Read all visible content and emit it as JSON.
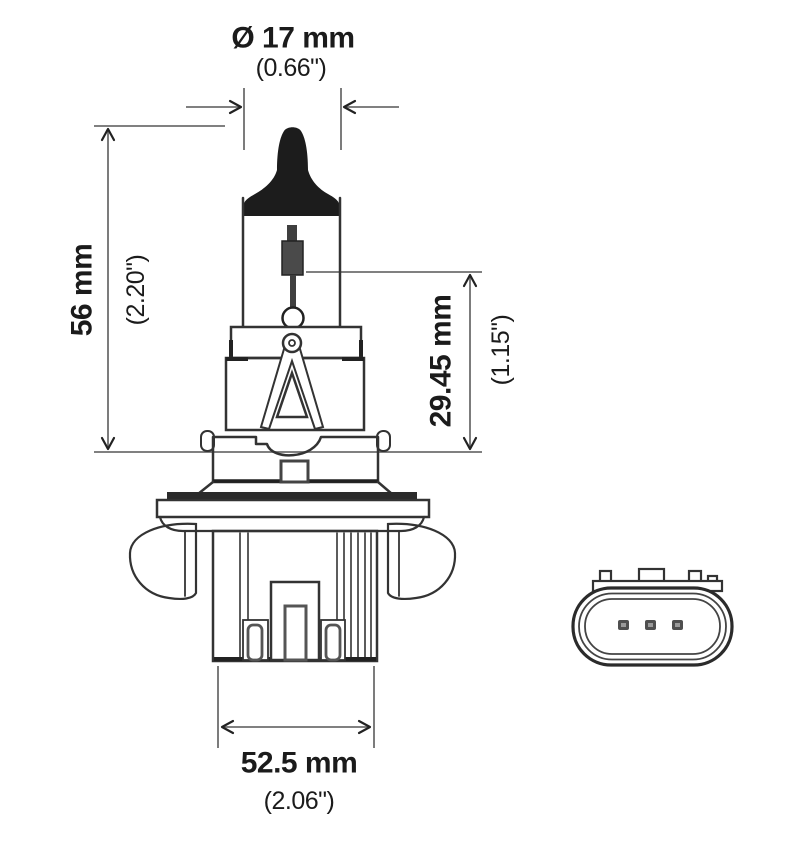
{
  "figure": {
    "dimensions": {
      "bulb_diameter": {
        "metric": "Ø 17 mm",
        "imperial": "(0.66\")"
      },
      "overall_height": {
        "metric": "56 mm",
        "imperial": "(2.20\")"
      },
      "filament_height": {
        "metric": "29.45 mm",
        "imperial": "(1.15\")"
      },
      "base_width": {
        "metric": "52.5 mm",
        "imperial": "(2.06\")"
      }
    },
    "connector": {
      "pin_count": "3"
    },
    "colors": {
      "background": "#ffffff",
      "outline": "#333333",
      "tip_fill": "#1c1c1c",
      "dimension_line": "#6e6e6e",
      "text": "#1b1b1b"
    }
  }
}
